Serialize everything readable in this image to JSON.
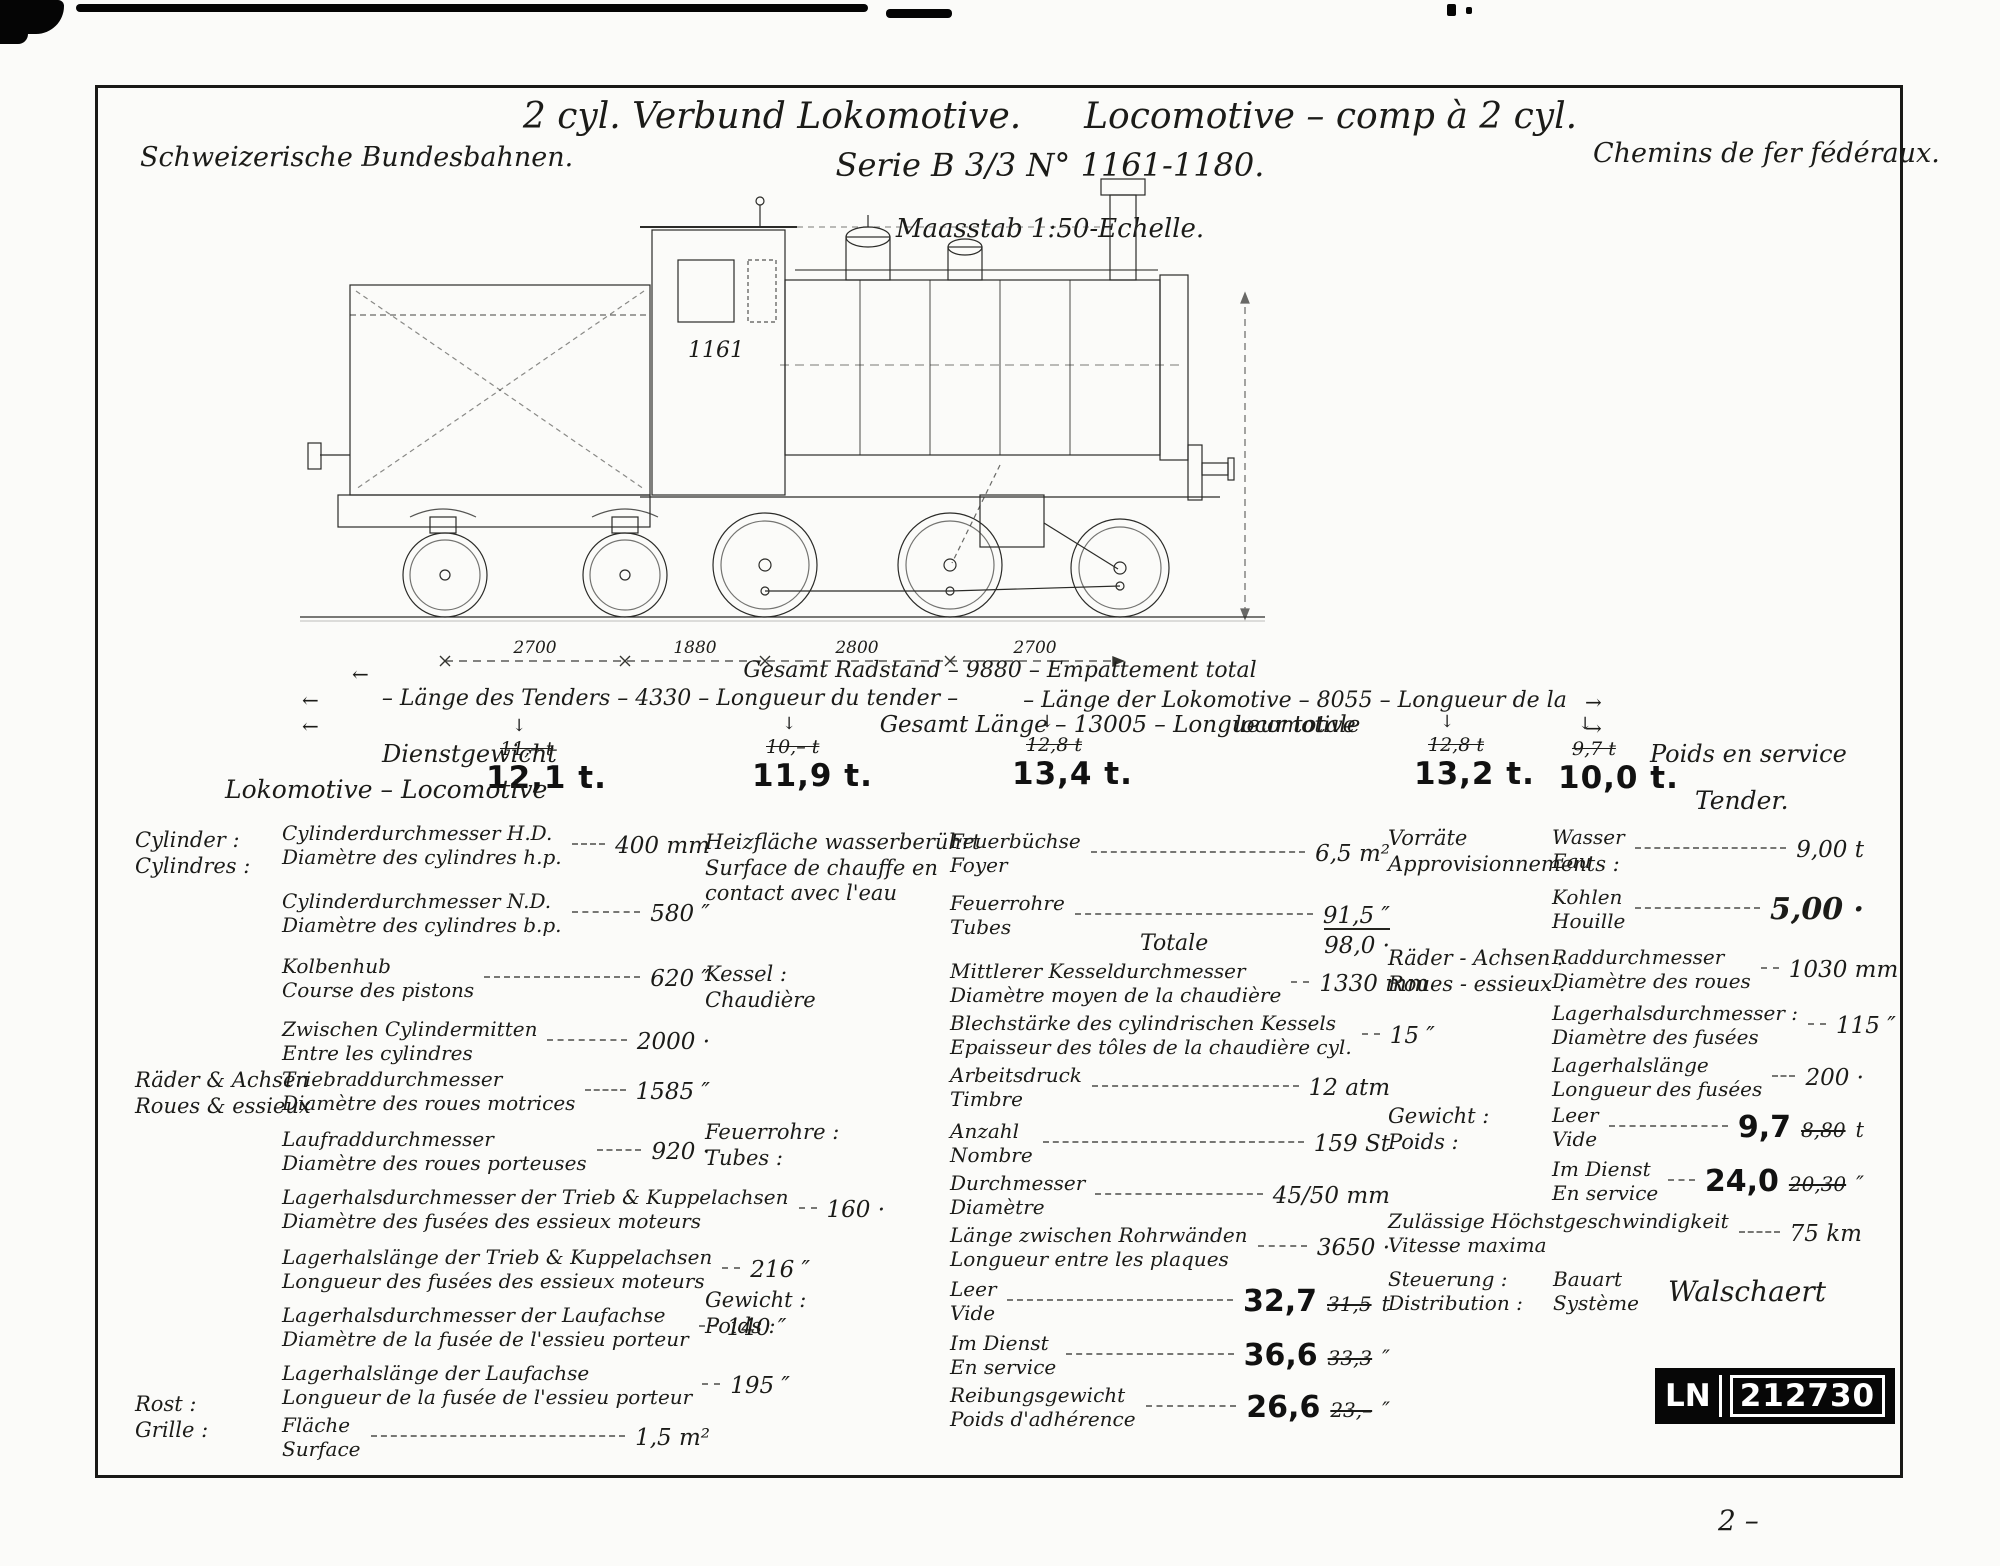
{
  "header": {
    "org_left": "Schweizerische Bundesbahnen.",
    "org_right": "Chemins de fer fédéraux.",
    "title_de": "2 cyl. Verbund Lokomotive.",
    "title_fr": "Locomotive – comp à 2 cyl.",
    "series": "Serie B 3/3 N° 1161-1180.",
    "scale": "Maasstab 1:50-Echelle."
  },
  "drawing": {
    "loco_number": "1161"
  },
  "dims": {
    "spans": [
      "2700",
      "1880",
      "2800",
      "2700"
    ],
    "wheelbase": "Gesamt  Radstand  –  9880 – Empattement total",
    "tender_length": "– Länge des Tenders – 4330 – Longueur du tender –",
    "loco_length": "– Länge der Lokomotive – 8055 – Longueur de la locomotive",
    "total_length": "Gesamt  Länge – 13005 –  Longueur totale"
  },
  "axle_loads": {
    "label_de": "Dienstgewicht",
    "label_fr": "Poids en service",
    "loco_label": "Lokomotive – Locomotive",
    "tender_label": "Tender.",
    "values": [
      {
        "old": "11,– t",
        "new": "12,1 t."
      },
      {
        "old": "10,– t",
        "new": "11,9 t."
      },
      {
        "old": "12,8 t",
        "new": "13,4 t."
      },
      {
        "old": "12,8 t",
        "new": "13,2 t."
      },
      {
        "old": "9,7 t",
        "new": "10,0 t."
      }
    ]
  },
  "specs": {
    "left": {
      "groups": [
        {
          "de": "Cylinder :",
          "fr": "Cylindres :"
        },
        {
          "de": "Räder & Achsen",
          "fr": "Roues & essieux"
        },
        {
          "de": "Rost :",
          "fr": "Grille :"
        }
      ],
      "rows": [
        {
          "de": "Cylinderdurchmesser   H.D.",
          "fr": "Diamètre des cylindres   h.p.",
          "value": "400 mm"
        },
        {
          "de": "Cylinderdurchmesser   N.D.",
          "fr": "Diamètre des cylindres   b.p.",
          "value": "580 ″"
        },
        {
          "de": "Kolbenhub",
          "fr": "Course des pistons",
          "value": "620 ″"
        },
        {
          "de": "Zwischen Cylindermitten",
          "fr": "Entre les cylindres",
          "value": "2000 ·"
        },
        {
          "de": "Triebraddurchmesser",
          "fr": "Diamètre des roues motrices",
          "value": "1585 ″"
        },
        {
          "de": "Laufraddurchmesser",
          "fr": "Diamètre des roues porteuses",
          "value": "920 ·"
        },
        {
          "de": "Lagerhalsdurchmesser der Trieb & Kuppelachsen",
          "fr": "Diamètre des fusées des essieux moteurs",
          "value": "160 ·"
        },
        {
          "de": "Lagerhalslänge der Trieb & Kuppelachsen",
          "fr": "Longueur des fusées des essieux moteurs",
          "value": "216 ″"
        },
        {
          "de": "Lagerhalsdurchmesser der Laufachse",
          "fr": "Diamètre de la fusée de l'essieu porteur",
          "value": "140 ″"
        },
        {
          "de": "Lagerhalslänge der Laufachse",
          "fr": "Longueur de la fusée de l'essieu porteur",
          "value": "195 ″"
        },
        {
          "de": "Fläche",
          "fr": "Surface",
          "value": "1,5 m²"
        }
      ]
    },
    "mid": {
      "heiz_label": [
        "Heizfläche wasserberührt",
        "Surface de chauffe en",
        "contact avec l'eau"
      ],
      "groups": [
        {
          "de": "Kessel :",
          "fr": "Chaudière"
        },
        {
          "de": "Feuerrohre :",
          "fr": "Tubes :"
        },
        {
          "de": "Gewicht :",
          "fr": "Poids :"
        }
      ],
      "total_label": "Totale",
      "rows": [
        {
          "de": "Feuerbüchse",
          "fr": "Foyer",
          "value": "6,5 m²"
        },
        {
          "de": "Feuerrohre",
          "fr": "Tubes",
          "value": "91,5 ″"
        },
        {
          "value": "98,0 ·"
        },
        {
          "de": "Mittlerer Kesseldurchmesser",
          "fr": "Diamètre moyen de la chaudière",
          "value": "1330 mm"
        },
        {
          "de": "Blechstärke des cylindrischen Kessels",
          "fr": "Epaisseur des tôles de la chaudière cyl.",
          "value": "15 ″"
        },
        {
          "de": "Arbeitsdruck",
          "fr": "Timbre",
          "value": "12 atm"
        },
        {
          "de": "Anzahl",
          "fr": "Nombre",
          "value": "159 St"
        },
        {
          "de": "Durchmesser",
          "fr": "Diamètre",
          "value": "45/50 mm"
        },
        {
          "de": "Länge zwischen Rohrwänden",
          "fr": "Longueur entre les plaques",
          "value": "3650 ·"
        },
        {
          "de": "Leer",
          "fr": "Vide",
          "new": "32,7",
          "old": "31,5",
          "unit": "t"
        },
        {
          "de": "Im Dienst",
          "fr": "En service",
          "new": "36,6",
          "old": "33,3",
          "unit": "″"
        },
        {
          "de": "Reibungsgewicht",
          "fr": "Poids d'adhérence",
          "new": "26,6",
          "old": "23,–",
          "unit": "″"
        }
      ]
    },
    "right": {
      "groups": [
        {
          "de": "Vorräte",
          "fr": "Approvisionnements :"
        },
        {
          "de": "Räder - Achsen :",
          "fr": "Roues - essieux ."
        },
        {
          "de": "Gewicht :",
          "fr": "Poids :"
        }
      ],
      "rows": [
        {
          "de": "Wasser",
          "fr": "Eau",
          "value": "9,00 t"
        },
        {
          "de": "Kohlen",
          "fr": "Houille",
          "value": "5,00 ·"
        },
        {
          "de": "Raddurchmesser",
          "fr": "Diamètre des roues",
          "value": "1030 mm"
        },
        {
          "de": "Lagerhalsdurchmesser :",
          "fr": "Diamètre des fusées",
          "value": "115 ″"
        },
        {
          "de": "Lagerhalslänge",
          "fr": "Longueur des fusées",
          "value": "200 ·"
        },
        {
          "de": "Leer",
          "fr": "Vide",
          "new": "9,7",
          "old": "8,80",
          "unit": "t"
        },
        {
          "de": "Im Dienst",
          "fr": "En service",
          "new": "24,0",
          "old": "20,30",
          "unit": "″"
        }
      ],
      "speed": {
        "de": "Zulässige Höchstgeschwindigkeit",
        "fr": "Vitesse maxima",
        "value": "75 km"
      },
      "steering": {
        "de": "Steuerung :",
        "fr": "Distribution :",
        "sub_de": "Bauart",
        "sub_fr": "Système",
        "value": "Walschaert"
      }
    }
  },
  "stamp": {
    "prefix": "LN",
    "number": "212730"
  },
  "page_number": "2 –"
}
